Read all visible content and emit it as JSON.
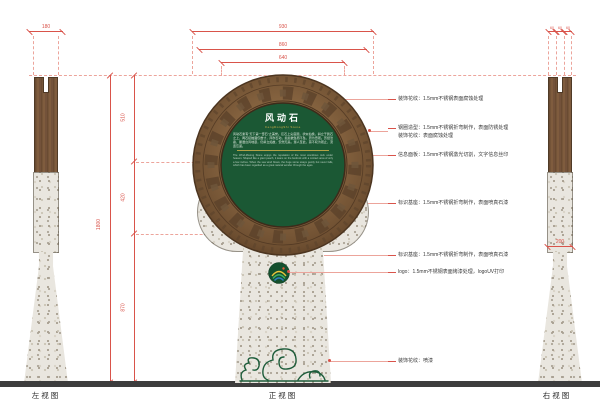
{
  "views": {
    "left_label": "左视图",
    "front_label": "正视图",
    "right_label": "右视图"
  },
  "dimensions": {
    "left_width": "180",
    "front_w_outer": "930",
    "front_w_ring": "860",
    "front_w_face": "640",
    "front_h_top": "510",
    "front_h_mid": "420",
    "front_h_bottom": "870",
    "front_h_total": "1800",
    "right_top_a": "60",
    "right_top_b": "60",
    "right_top_c": "60",
    "right_waist": "200"
  },
  "sign": {
    "title": "风动石",
    "subtitle": "FengDongShi Stone",
    "body_cn": "风动石素有“天下第一奇石”之美誉。巨石上尖底圆，状似仙桃，斜立于磐石之上，两石接触面仅数寸，风吹石动，摇摇欲坠而不坠，蔚为奇观。历经沧桑，屡遭台风地震，仍斜立如故，安然无恙。游人至此，莫不叹为观止，流连忘返。",
    "body_en": "The Wind-Moving Stone enjoys the reputation of the most wondrous rock under heaven. Shaped like a giant peach, it leans on the bedrock with a contact area of only a few inches. When the sea wind blows, the huge stone sways gently but never falls, which has been regarded as a great natural wonder through the ages."
  },
  "annotations": [
    {
      "text": "装饰花纹：1.5mm不锈钢表面腐蚀处理"
    },
    {
      "text": "钢圈造型：1.5mm不锈钢折弯制作，表面防锈处理"
    },
    {
      "text": "装饰花纹：表面腐蚀处理"
    },
    {
      "text": "信息面板：1.5mm不锈钢激光切割，文字信息丝印"
    },
    {
      "text": "标识基座：1.5mm不锈钢折弯制作，表面喷真石漆"
    },
    {
      "text": "标识基座：1.5mm不锈钢折弯制作，表面喷真石漆"
    },
    {
      "text": "logo：1.5mm不锈钢表面烤漆处理，logoUV打印"
    },
    {
      "text": "装饰花纹：喷漆"
    }
  ],
  "colors": {
    "dimension_red": "#d9534a",
    "bronze_ring": "#82613f",
    "sign_green": "#1b5834",
    "gold": "#d8b54a",
    "granite": "#e9e6df",
    "wave_green": "#1d5c3a",
    "ground": "#3d3d3d"
  }
}
